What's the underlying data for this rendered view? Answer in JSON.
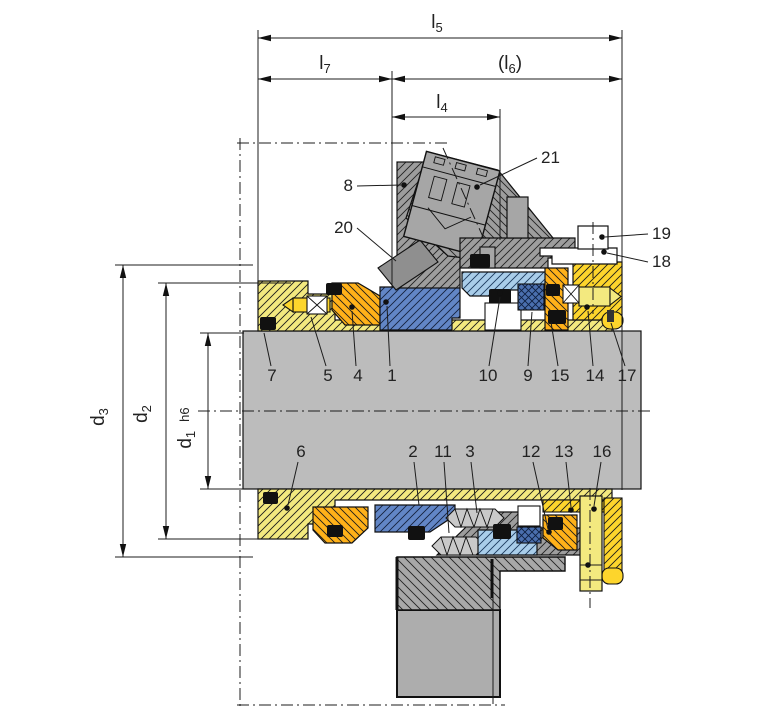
{
  "drawing": {
    "dimensions": {
      "l5": {
        "base": "l",
        "sub": "5"
      },
      "l7": {
        "base": "l",
        "sub": "7"
      },
      "l6": {
        "open": "(",
        "base": "l",
        "sub": "6",
        "close": ")"
      },
      "l4": {
        "base": "l",
        "sub": "4"
      },
      "d3": {
        "base": "d",
        "sub": "3"
      },
      "d2": {
        "base": "d",
        "sub": "2"
      },
      "d1": {
        "base": "d",
        "sub": "1",
        "tol": "h6"
      }
    },
    "parts": {
      "p1": "1",
      "p2": "2",
      "p3": "3",
      "p4": "4",
      "p5": "5",
      "p6": "6",
      "p7": "7",
      "p8": "8",
      "p9": "9",
      "p10": "10",
      "p11": "11",
      "p12": "12",
      "p13": "13",
      "p14": "14",
      "p15": "15",
      "p16": "16",
      "p17": "17",
      "p18": "18",
      "p19": "19",
      "p20": "20",
      "p21": "21"
    },
    "colors": {
      "sleeve_yellow": "#f3e97f",
      "collar_yellow": "#fdd52c",
      "thrust_orange": "#ffb119",
      "seal_ring_blue": "#6286c6",
      "seat_light_blue": "#a9cde9",
      "gasket_cross_blue": "#4a6fae",
      "shaft_gray": "#bcbcbc",
      "gland_gray": "#9d9d9d",
      "housing_gray": "#a8a8a8",
      "oring_black": "#111111"
    }
  }
}
